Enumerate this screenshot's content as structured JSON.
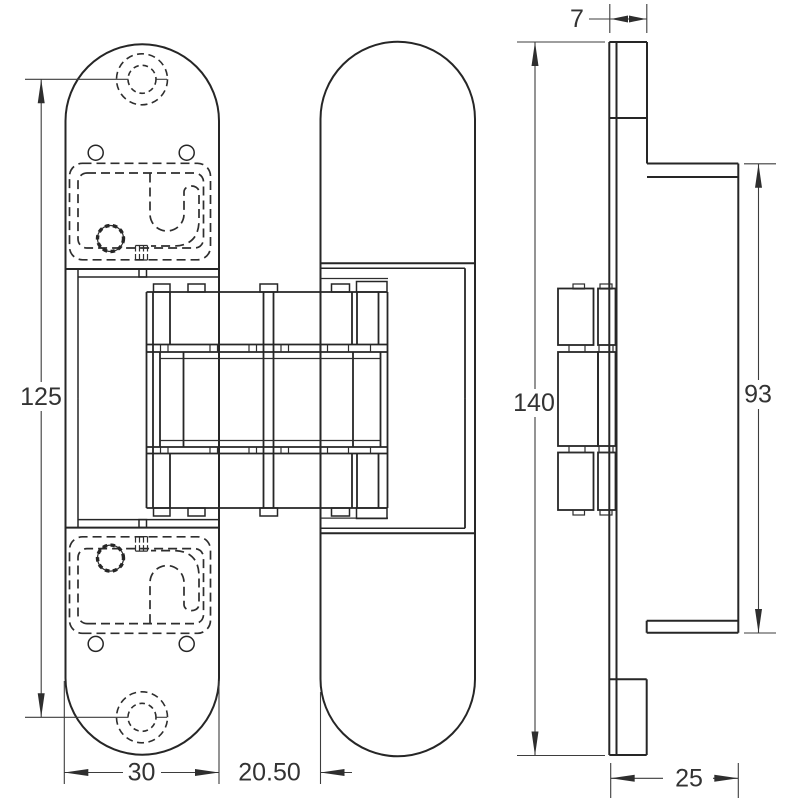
{
  "drawing": {
    "colors": {
      "background": "#ffffff",
      "line": "#262626",
      "dimension_line": "#3d3d3d",
      "text": "#333333"
    },
    "dimensions": {
      "hole_spacing": "125",
      "leaf_width": "30",
      "leaf_gap": "20.50",
      "overall_height": "140",
      "side_flange_height": "93",
      "plate_thickness": "7",
      "side_depth": "25"
    }
  }
}
